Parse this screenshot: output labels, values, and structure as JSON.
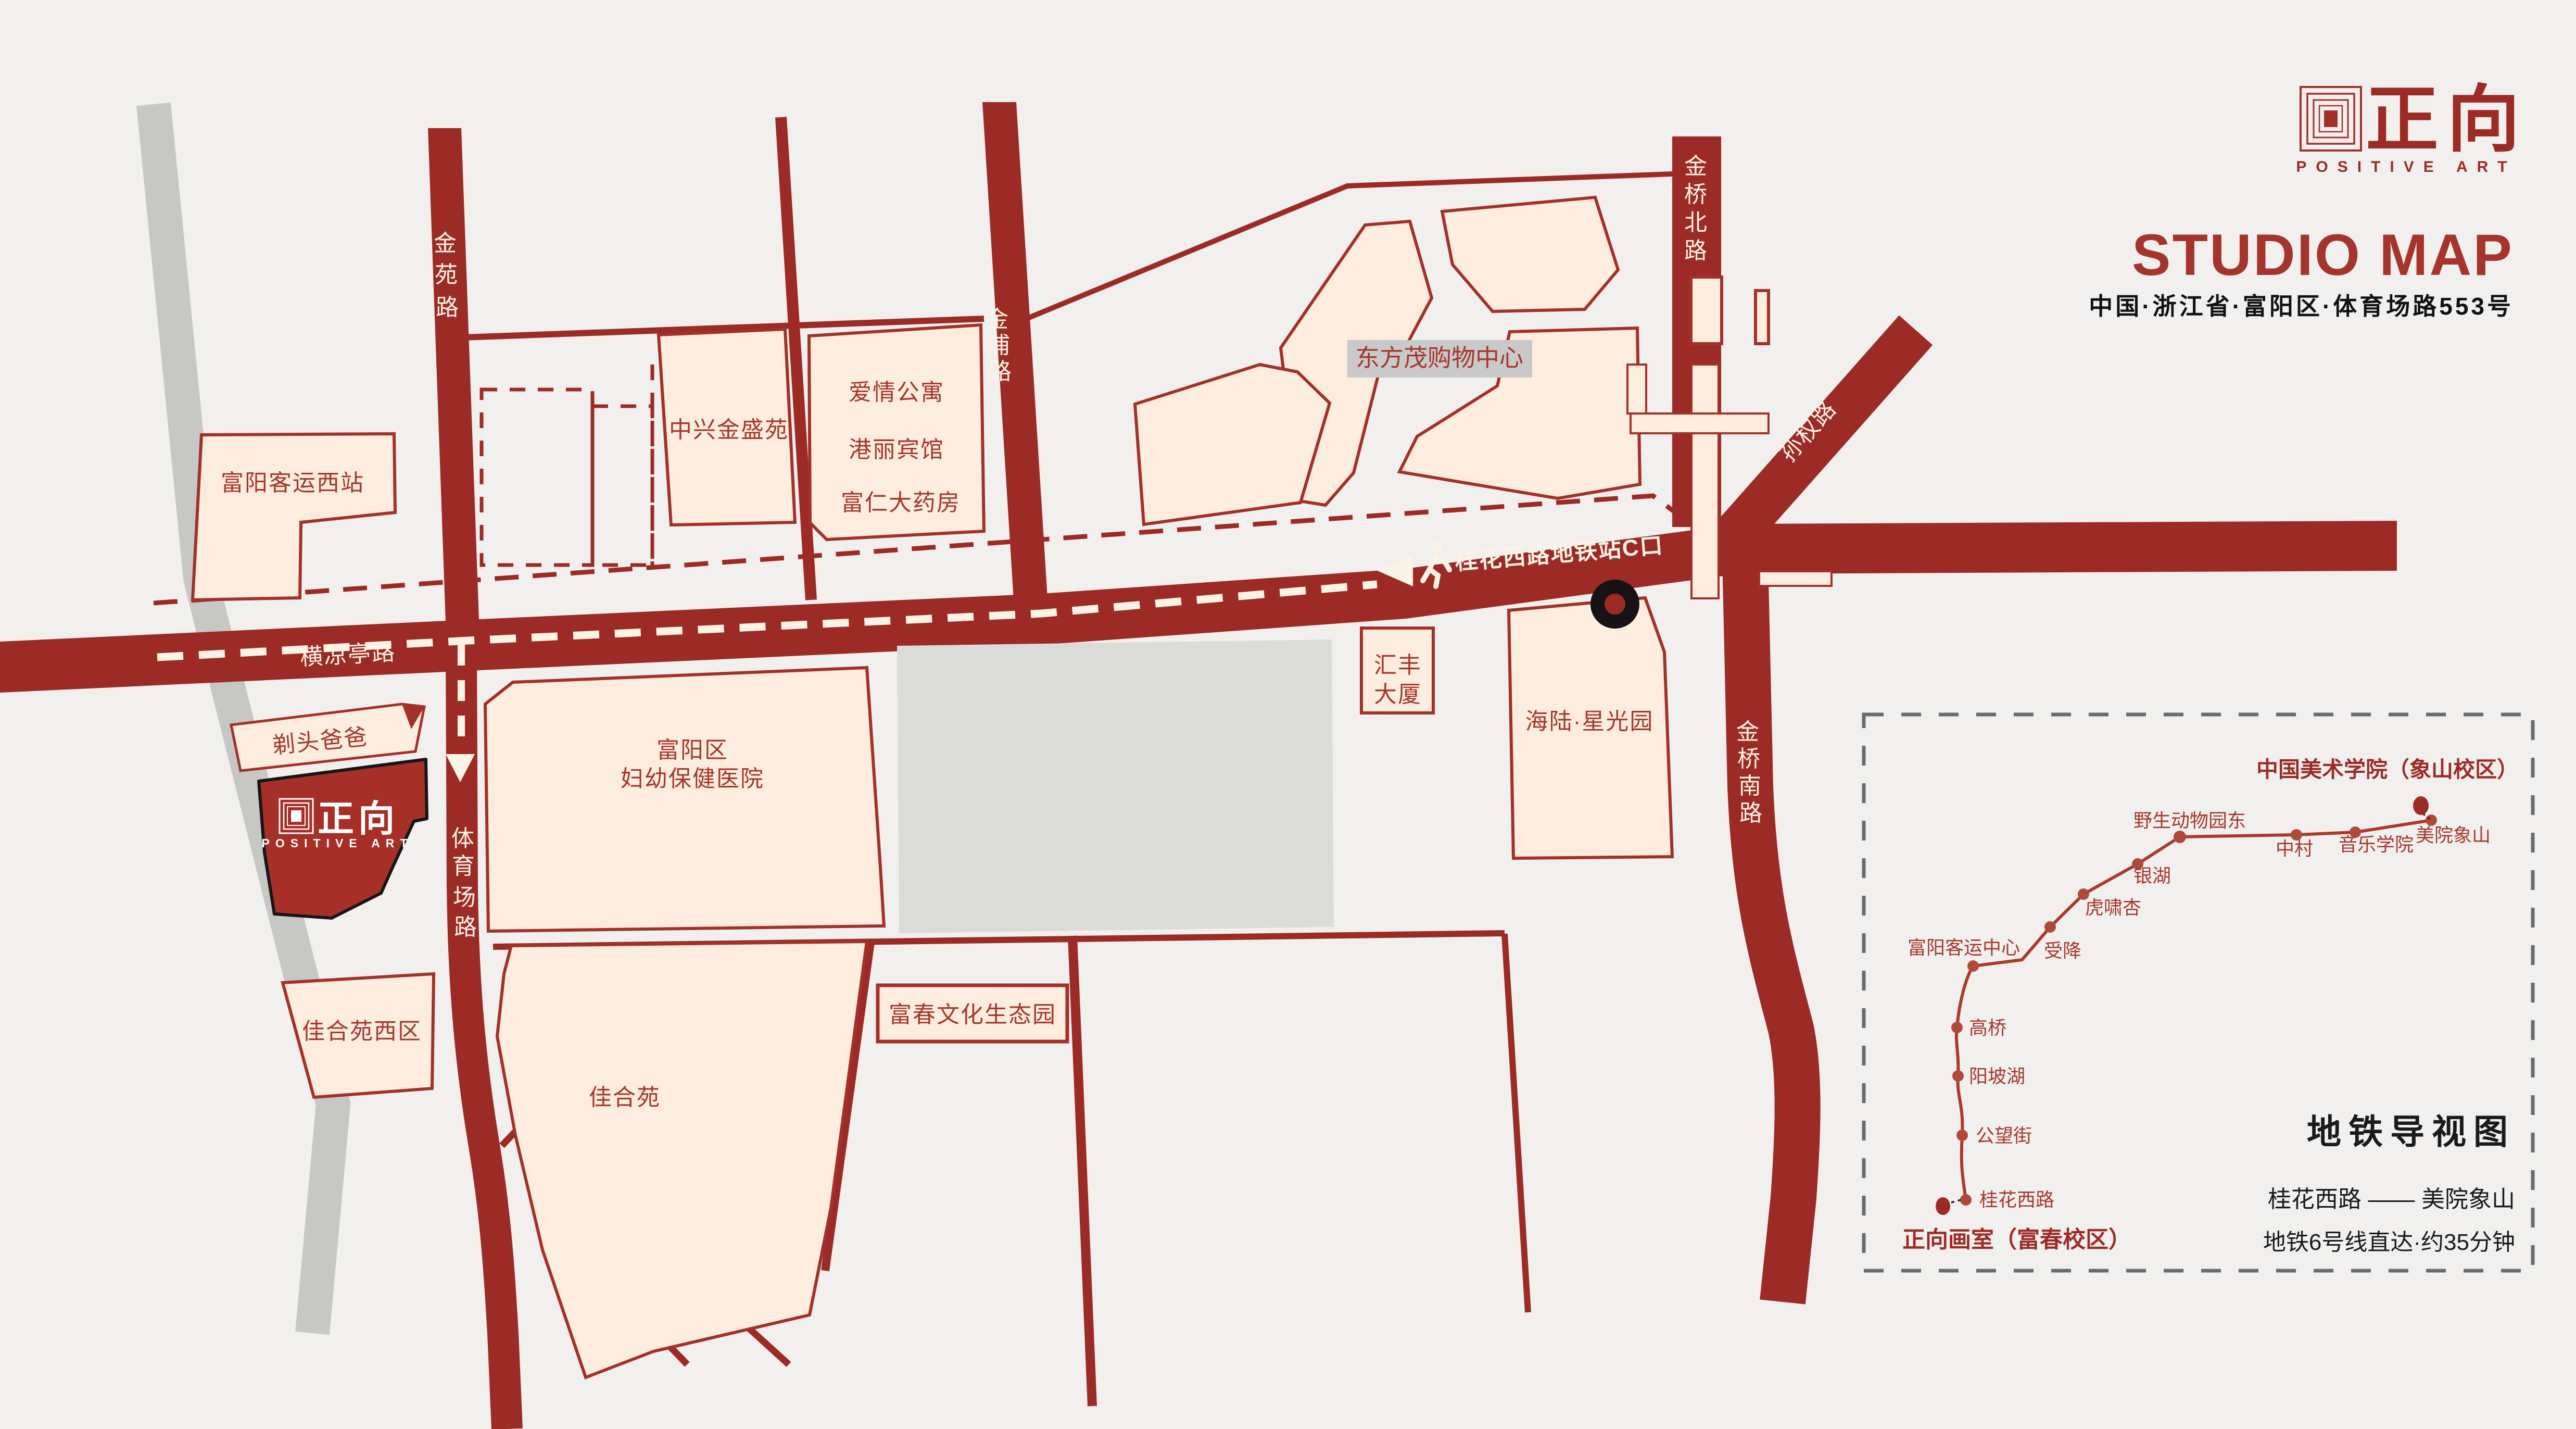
{
  "header": {
    "logo_cn": "正向",
    "logo_en": "POSITIVE ART",
    "title": "STUDIO MAP",
    "address": "中国·浙江省·富阳区·体育场路553号"
  },
  "map": {
    "roads": {
      "jinyuan": {
        "name": "金苑路",
        "chars": [
          "金",
          "苑",
          "路"
        ]
      },
      "jinpu": {
        "name": "金浦路",
        "chars": [
          "金",
          "浦",
          "路"
        ]
      },
      "jinqiao_north": {
        "name": "金桥北路",
        "chars": [
          "金",
          "桥",
          "北",
          "路"
        ]
      },
      "jinqiao_south": {
        "name": "金桥南路",
        "chars": [
          "金",
          "桥",
          "南",
          "路"
        ]
      },
      "tiyuchang": {
        "name": "体育场路",
        "chars": [
          "体",
          "育",
          "场",
          "路"
        ]
      },
      "sunquan": {
        "name": "孙权路"
      },
      "hengliangting": {
        "name": "横凉亭路"
      }
    },
    "route": {
      "label": "桂花西路地铁站C口"
    },
    "buildings": {
      "bus_station_west": "富阳客运西站",
      "zhongxing": "中兴金盛苑",
      "aiqing": "爱情公寓",
      "gangli": "港丽宾馆",
      "furen": "富仁大药房",
      "dongfangmao": "东方茂购物中心",
      "huifeng_line1": "汇丰",
      "huifeng_line2": "大厦",
      "hailu": "海陆·星光园",
      "titou_baba": "剃头爸爸",
      "hospital_line1": "富阳区",
      "hospital_line2": "妇幼保健医院",
      "jiaheyuan_west": "佳合苑西区",
      "jiaheyuan": "佳合苑",
      "fuchun_park": "富春文化生态园"
    },
    "studio": {
      "logo_cn": "正向",
      "logo_en": "POSITIVE ART"
    }
  },
  "metro_panel": {
    "title": "地铁导视图",
    "route_line": "桂花西路 —— 美院象山",
    "note": "地铁6号线直达·约35分钟",
    "terminal_top": "中国美术学院（象山校区）",
    "terminal_bottom": "正向画室（富春校区）",
    "stations": [
      "桂花西路",
      "公望街",
      "阳坡湖",
      "高桥",
      "富阳客运中心",
      "受降",
      "虎啸杏",
      "银湖",
      "野生动物园东",
      "中村",
      "音乐学院",
      "美院象山"
    ]
  },
  "colors": {
    "background": "#f1f0ee",
    "road_red": "#9c2b26",
    "building_cream": "#fcedde",
    "building_outline": "#a33129",
    "label_red": "#a4372c",
    "gray_road": "#c7c7c6",
    "gray_block": "#dbdbda",
    "metro_line": "#aa3a2c",
    "black": "#1a1a1a"
  }
}
